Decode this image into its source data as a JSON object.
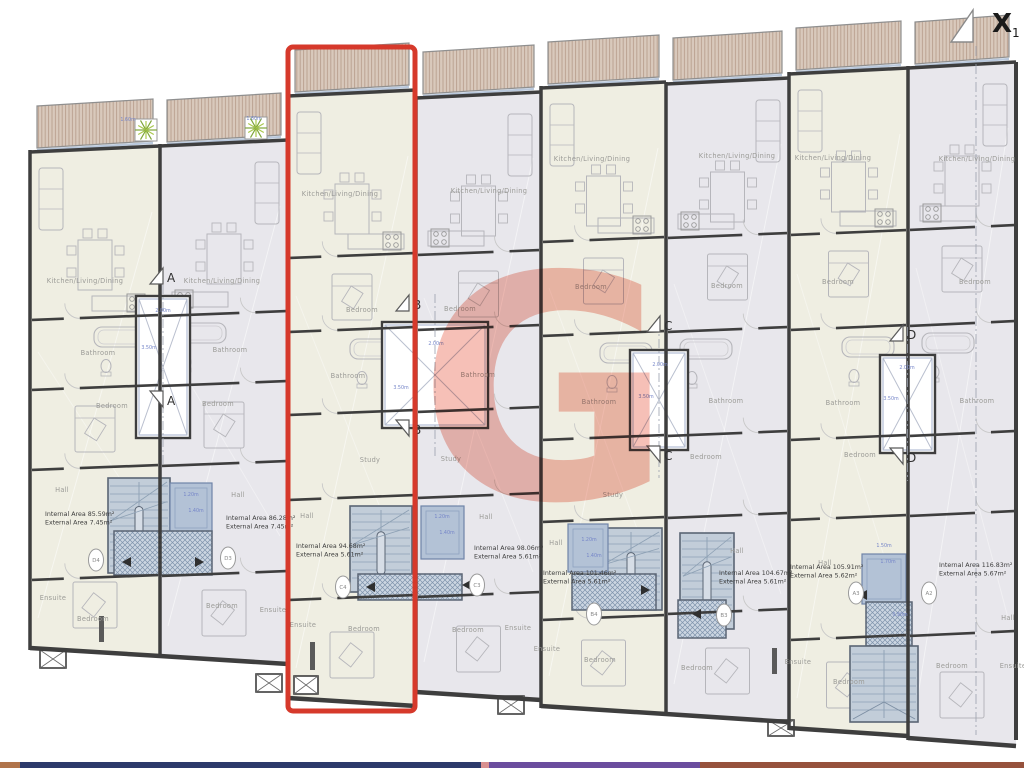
{
  "watermark": {
    "letter": "G"
  },
  "section_ref": {
    "label": "X",
    "sub": "1"
  },
  "colors": {
    "highlight": "#d6392b",
    "watermark": "#f0998b",
    "cream": "#efeee2",
    "grey": "#e8e7ec",
    "wall": "#3e3e3e",
    "stair_fill": "#c2cdd9",
    "stair_edge": "#5a6574",
    "dim_blue": "#7585c8",
    "label_grey": "#9b9b97",
    "area_text": "#3d3d3d",
    "terrace": "#d9c9bc",
    "plant_green": "#7fa53a"
  },
  "room_labels": [
    {
      "t": "Kitchen/Living/Dining",
      "x": 85,
      "y": 283
    },
    {
      "t": "Kitchen/Living/Dining",
      "x": 222,
      "y": 283
    },
    {
      "t": "Kitchen/Living/Dining",
      "x": 340,
      "y": 196
    },
    {
      "t": "Kitchen/Living/Dining",
      "x": 489,
      "y": 193
    },
    {
      "t": "Kitchen/Living/Dining",
      "x": 592,
      "y": 161
    },
    {
      "t": "Kitchen/Living/Dining",
      "x": 737,
      "y": 158
    },
    {
      "t": "Kitchen/Living/Dining",
      "x": 833,
      "y": 160
    },
    {
      "t": "Kitchen/Living/Dining",
      "x": 977,
      "y": 161
    },
    {
      "t": "Bathroom",
      "x": 98,
      "y": 355
    },
    {
      "t": "Bathroom",
      "x": 230,
      "y": 352
    },
    {
      "t": "Bedroom",
      "x": 112,
      "y": 408
    },
    {
      "t": "Bedroom",
      "x": 218,
      "y": 406
    },
    {
      "t": "Hall",
      "x": 62,
      "y": 492
    },
    {
      "t": "Hall",
      "x": 238,
      "y": 497
    },
    {
      "t": "Ensuite",
      "x": 53,
      "y": 600
    },
    {
      "t": "Bedroom",
      "x": 93,
      "y": 621
    },
    {
      "t": "Bedroom",
      "x": 222,
      "y": 608
    },
    {
      "t": "Ensuite",
      "x": 273,
      "y": 612
    },
    {
      "t": "Bedroom",
      "x": 362,
      "y": 312
    },
    {
      "t": "Bathroom",
      "x": 348,
      "y": 378
    },
    {
      "t": "Study",
      "x": 370,
      "y": 462
    },
    {
      "t": "Hall",
      "x": 307,
      "y": 518
    },
    {
      "t": "Ensuite",
      "x": 303,
      "y": 627
    },
    {
      "t": "Bedroom",
      "x": 364,
      "y": 631
    },
    {
      "t": "Bedroom",
      "x": 460,
      "y": 311
    },
    {
      "t": "Bathroom",
      "x": 478,
      "y": 377
    },
    {
      "t": "Study",
      "x": 451,
      "y": 461
    },
    {
      "t": "Hall",
      "x": 486,
      "y": 519
    },
    {
      "t": "Bedroom",
      "x": 468,
      "y": 632
    },
    {
      "t": "Ensuite",
      "x": 518,
      "y": 630
    },
    {
      "t": "Bedroom",
      "x": 591,
      "y": 289
    },
    {
      "t": "Bathroom",
      "x": 599,
      "y": 404
    },
    {
      "t": "Study",
      "x": 613,
      "y": 497
    },
    {
      "t": "Hall",
      "x": 556,
      "y": 545
    },
    {
      "t": "Ensuite",
      "x": 547,
      "y": 651
    },
    {
      "t": "Bedroom",
      "x": 600,
      "y": 662
    },
    {
      "t": "Bedroom",
      "x": 727,
      "y": 288
    },
    {
      "t": "Bathroom",
      "x": 726,
      "y": 403
    },
    {
      "t": "Bedroom",
      "x": 706,
      "y": 459
    },
    {
      "t": "Hall",
      "x": 737,
      "y": 553
    },
    {
      "t": "Bedroom",
      "x": 697,
      "y": 670
    },
    {
      "t": "Bedroom",
      "x": 838,
      "y": 284
    },
    {
      "t": "Bathroom",
      "x": 843,
      "y": 405
    },
    {
      "t": "Bedroom",
      "x": 860,
      "y": 457
    },
    {
      "t": "Hall",
      "x": 825,
      "y": 565
    },
    {
      "t": "Ensuite",
      "x": 798,
      "y": 664
    },
    {
      "t": "Bedroom",
      "x": 849,
      "y": 684
    },
    {
      "t": "Bedroom",
      "x": 975,
      "y": 284
    },
    {
      "t": "Bathroom",
      "x": 977,
      "y": 403
    },
    {
      "t": "Hall",
      "x": 1008,
      "y": 620
    },
    {
      "t": "Bedroom",
      "x": 952,
      "y": 668
    },
    {
      "t": "Ensuite",
      "x": 1013,
      "y": 668
    }
  ],
  "area_labels": [
    {
      "internal": "Internal Area 85.59m²",
      "external": "External Area 7.45m²",
      "x": 45,
      "y": 516
    },
    {
      "internal": "Internal Area 86.28m²",
      "external": "External Area 7.45m²",
      "x": 226,
      "y": 520
    },
    {
      "internal": "Internal Area 94.68m²",
      "external": "External Area 5.61m²",
      "x": 296,
      "y": 548
    },
    {
      "internal": "Internal Area 98.06m²",
      "external": "External Area 5.61m²",
      "x": 474,
      "y": 550
    },
    {
      "internal": "Internal Area 101.46m²",
      "external": "External Area 5.61m²",
      "x": 543,
      "y": 575
    },
    {
      "internal": "Internal Area 104.67m²",
      "external": "External Area 5.61m²",
      "x": 719,
      "y": 575
    },
    {
      "internal": "Internal Area 105.91m²",
      "external": "External Area 5.62m²",
      "x": 790,
      "y": 569
    },
    {
      "internal": "Internal Area 116.83m²",
      "external": "External Area 5.67m²",
      "x": 939,
      "y": 567
    }
  ],
  "door_tags": [
    {
      "t": "D4",
      "x": 96,
      "y": 560
    },
    {
      "t": "D3",
      "x": 228,
      "y": 558
    },
    {
      "t": "C4",
      "x": 343,
      "y": 587
    },
    {
      "t": "C3",
      "x": 477,
      "y": 585
    },
    {
      "t": "B4",
      "x": 594,
      "y": 614
    },
    {
      "t": "B3",
      "x": 724,
      "y": 615
    },
    {
      "t": "A3",
      "x": 856,
      "y": 593
    },
    {
      "t": "A2",
      "x": 929,
      "y": 593
    }
  ],
  "section_markers": [
    {
      "t": "A",
      "x": 150,
      "y": 284,
      "d": "up"
    },
    {
      "t": "A",
      "x": 150,
      "y": 407,
      "d": "down"
    },
    {
      "t": "B",
      "x": 396,
      "y": 311,
      "d": "up"
    },
    {
      "t": "B",
      "x": 396,
      "y": 436,
      "d": "down"
    },
    {
      "t": "C",
      "x": 647,
      "y": 332,
      "d": "up"
    },
    {
      "t": "C",
      "x": 647,
      "y": 462,
      "d": "down"
    },
    {
      "t": "D",
      "x": 890,
      "y": 341,
      "d": "up"
    },
    {
      "t": "D",
      "x": 890,
      "y": 464,
      "d": "down"
    }
  ],
  "dimensions": [
    {
      "t": "1.60m",
      "x": 128,
      "y": 121
    },
    {
      "t": "1.60m",
      "x": 254,
      "y": 120
    },
    {
      "t": "2.00m",
      "x": 163,
      "y": 312
    },
    {
      "t": "3.50m",
      "x": 149,
      "y": 349
    },
    {
      "t": "2.00m",
      "x": 436,
      "y": 345
    },
    {
      "t": "3.50m",
      "x": 401,
      "y": 389
    },
    {
      "t": "2.00m",
      "x": 660,
      "y": 366
    },
    {
      "t": "3.50m",
      "x": 646,
      "y": 398
    },
    {
      "t": "2.00m",
      "x": 907,
      "y": 369
    },
    {
      "t": "3.50m",
      "x": 891,
      "y": 400
    },
    {
      "t": "1.20m",
      "x": 191,
      "y": 496
    },
    {
      "t": "1.40m",
      "x": 196,
      "y": 512
    },
    {
      "t": "1.20m",
      "x": 442,
      "y": 518
    },
    {
      "t": "1.40m",
      "x": 447,
      "y": 534
    },
    {
      "t": "1.20m",
      "x": 589,
      "y": 541
    },
    {
      "t": "1.40m",
      "x": 594,
      "y": 557
    },
    {
      "t": "1.50m",
      "x": 884,
      "y": 547
    },
    {
      "t": "1.70m",
      "x": 888,
      "y": 563
    },
    {
      "t": "0.90m",
      "x": 900,
      "y": 616
    }
  ],
  "bottom_strip": [
    {
      "x0": 0,
      "x1": 20,
      "color": "#b0744b"
    },
    {
      "x0": 20,
      "x1": 481,
      "color": "#2c3a6b"
    },
    {
      "x0": 481,
      "x1": 489,
      "color": "#d99090"
    },
    {
      "x0": 489,
      "x1": 700,
      "color": "#6b4d9e"
    },
    {
      "x0": 700,
      "x1": 1024,
      "color": "#96513c"
    }
  ]
}
